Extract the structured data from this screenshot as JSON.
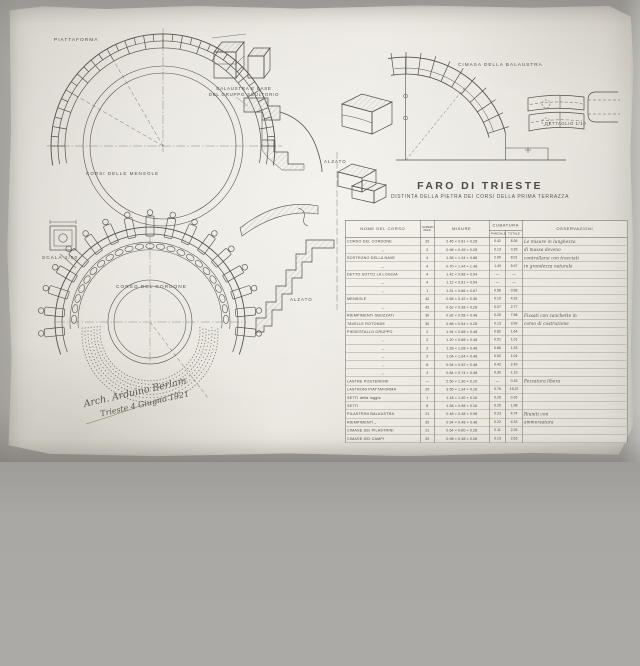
{
  "colors": {
    "paper": "#e2dfd7",
    "ink": "#514e48",
    "pencil": "#8a867c"
  },
  "title": {
    "main": "FARO DI TRIESTE",
    "subtitle": "DISTINTA DELLA PIETRA  DEI CORSI DELLA PRIMA TERRAZZA"
  },
  "labels": {
    "piattaforma": "PIATTAFORMA",
    "balaustra_line1": "BALAUSTRA E BASE",
    "balaustra_line2": "DEL GRUPPO SCULTORIO",
    "corsi_mensole": "CORSI DELLE MENSOLE",
    "scala": "SCALA 1/50",
    "corso_cordone": "CORSO DEL CORDONE",
    "alzato_arch": "ALZATO",
    "alzato_section": "ALZATO",
    "cimasa": "CIMASA DELLA BALAUSTRA",
    "dettaglio": "DETTAGLIO 1/10"
  },
  "signature": {
    "line1": "Arch. Arduino Berlam",
    "line2": "Trieste 4 Giugno 1921"
  },
  "table": {
    "headers": {
      "nome": "NOME DEL CORSO",
      "numero_line1": "NUMERO",
      "numero_line2": "PEZZI",
      "misure": "MISURE",
      "cubatura": "CUBATURA",
      "parziale": "PARZIALE",
      "totale": "TOTALE",
      "osservazioni": "OSSERVAZIONI"
    },
    "rows": [
      {
        "name": "CORSO DEL CORDONE",
        "pezzi": "20",
        "misure": "2.45 × 0.61 × 0.28",
        "parziale": "0.42",
        "totale": "8.36",
        "oss": "Le misure in lunghezza"
      },
      {
        "name": "„",
        "pezzi": "2",
        "misure": "0.98 × 0.49 × 0.28",
        "parziale": "0.13",
        "totale": "0.26",
        "oss": "di massa devono"
      },
      {
        "name": "SOSTEGNO DELLA NAVE",
        "pezzi": "4",
        "misure": "1.58 × 1.44 × 0.88",
        "parziale": "2.00",
        "totale": "8.01",
        "oss": "controllarsi con tracciati"
      },
      {
        "name": "„",
        "pezzi": "4",
        "misure": "0.70 × 1.44 × 1.48",
        "parziale": "1.49",
        "totale": "5.97",
        "oss": "in grandezza naturale"
      },
      {
        "name": "DETTO SOTTO LA LOGGIA",
        "pezzi": "4",
        "misure": "1.42 × 0.88 × 0.54",
        "parziale": "—",
        "totale": "—",
        "oss": ""
      },
      {
        "name": "„",
        "pezzi": "4",
        "misure": "1.12 × 0.81 × 0.54",
        "parziale": "—",
        "totale": "—",
        "oss": ""
      },
      {
        "name": "„",
        "pezzi": "1",
        "misure": "1.31 × 0.66 × 0.67",
        "parziale": "0.58",
        "totale": "0.58",
        "oss": ""
      },
      {
        "name": "MENSOLE",
        "pezzi": "42",
        "misure": "0.68 × 0.42 × 0.36",
        "parziale": "0.10",
        "totale": "4.32",
        "oss": ""
      },
      {
        "name": "„",
        "pezzi": "42",
        "misure": "0.62 × 0.38 × 0.28",
        "parziale": "0.07",
        "totale": "2.77",
        "oss": ""
      },
      {
        "name": "RIEMPIMENTI SBOZZATI",
        "pezzi": "30",
        "misure": "0.92 × 0.58 × 0.48",
        "parziale": "0.26",
        "totale": "7.68",
        "oss": "Fissati con zanchette in"
      },
      {
        "name": "TAVELLE ROTONDE",
        "pezzi": "30",
        "misure": "0.88 × 0.54 × 0.28",
        "parziale": "0.13",
        "totale": "3.99",
        "oss": "corso di costruzione"
      },
      {
        "name": "PIEDESTALLO  GRUPPO",
        "pezzi": "2",
        "misure": "1.94 × 0.88 × 0.48",
        "parziale": "0.82",
        "totale": "1.64",
        "oss": ""
      },
      {
        "name": "„",
        "pezzi": "2",
        "misure": "1.20 × 0.88 × 0.48",
        "parziale": "0.51",
        "totale": "1.01",
        "oss": ""
      },
      {
        "name": "„",
        "pezzi": "2",
        "misure": "1.28 × 1.08 × 0.48",
        "parziale": "0.66",
        "totale": "1.33",
        "oss": ""
      },
      {
        "name": "„",
        "pezzi": "2",
        "misure": "1.04 × 1.04 × 0.48",
        "parziale": "0.52",
        "totale": "1.04",
        "oss": ""
      },
      {
        "name": "„",
        "pezzi": "6",
        "misure": "0.94 × 0.92 × 0.48",
        "parziale": "0.42",
        "totale": "2.49",
        "oss": ""
      },
      {
        "name": "„",
        "pezzi": "4",
        "misure": "0.84 × 0.74 × 0.48",
        "parziale": "0.30",
        "totale": "1.19",
        "oss": ""
      },
      {
        "name": "LASTRE POSTERIORI",
        "pezzi": "—",
        "misure": "2.50 × 1.30 × 0.10",
        "parziale": "—",
        "totale": "0.33",
        "oss": "Pezzatura libera"
      },
      {
        "name": "LASTRONI PIATTAFORMA",
        "pezzi": "20",
        "misure": "3.55 × 1.34 × 0.16",
        "parziale": "0.76",
        "totale": "15.22",
        "oss": ""
      },
      {
        "name": "SETTI della loggia",
        "pezzi": "1",
        "misure": "1.18 × 1.40 × 0.16",
        "parziale": "0.26",
        "totale": "0.26",
        "oss": ""
      },
      {
        "name": "SETTI",
        "pezzi": "8",
        "misure": "1.58 × 0.98 × 0.16",
        "parziale": "0.25",
        "totale": "1.98",
        "oss": ""
      },
      {
        "name": "PILASTRINI BALAUSTRA",
        "pezzi": "21",
        "misure": "0.48 × 0.48 × 0.98",
        "parziale": "0.23",
        "totale": "4.74",
        "oss": "Riuniti con"
      },
      {
        "name": "RIEMPIMENTI „",
        "pezzi": "20",
        "misure": "0.94 × 0.48 × 0.48",
        "parziale": "0.22",
        "totale": "4.33",
        "oss": "ammorsatura"
      },
      {
        "name": "CIMASE DEI PILASTRINI",
        "pezzi": "21",
        "misure": "0.64 × 0.60 × 0.28",
        "parziale": "0.11",
        "totale": "2.26",
        "oss": ""
      },
      {
        "name": "CIMASE DEI CAMPI",
        "pezzi": "20",
        "misure": "0.98 × 0.48 × 0.28",
        "parziale": "0.13",
        "totale": "2.63",
        "oss": ""
      }
    ]
  }
}
